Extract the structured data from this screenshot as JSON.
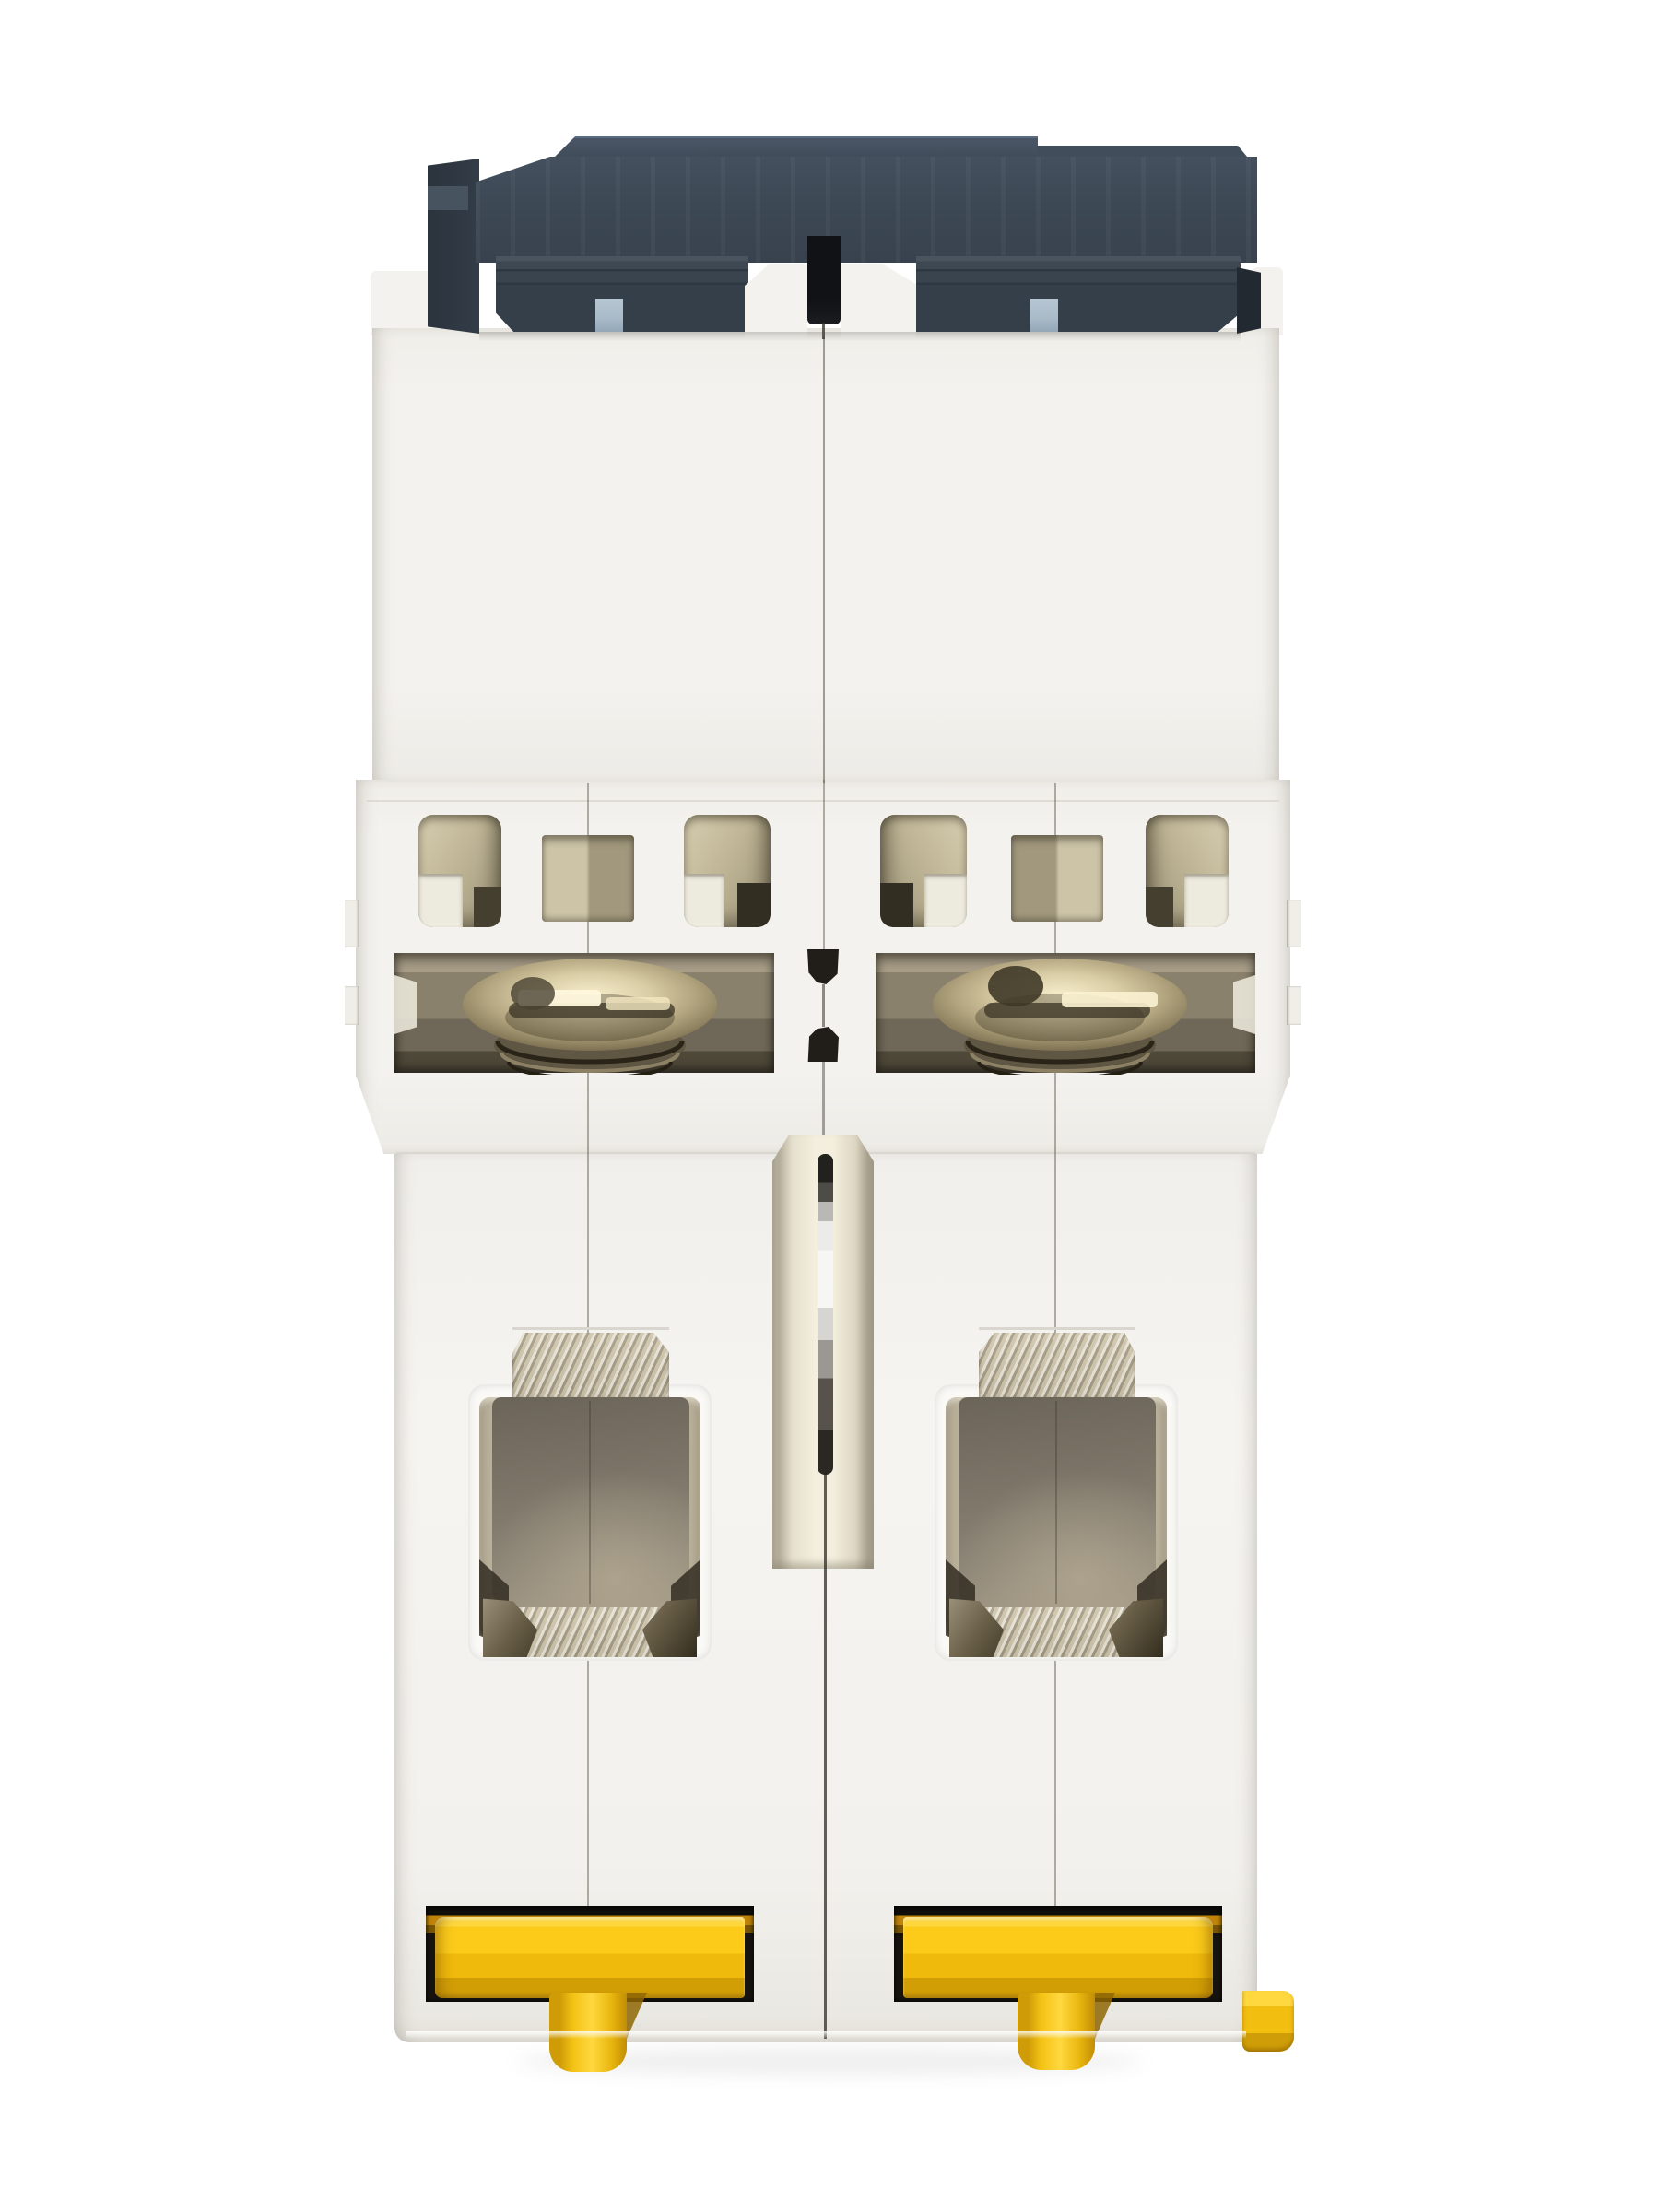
{
  "scene": {
    "subject": "Two-pole miniature circuit breaker, white housing, viewed from the underside on a plain white background",
    "view": "bottom / DIN-rail side",
    "modules": 2
  },
  "parts": {
    "device": {
      "label": "2-pole circuit breaker, underside view"
    },
    "cap": {
      "label": "dark grey top cap"
    },
    "blue_tab": {
      "label": "light blue latch tab"
    },
    "housing_upper": {
      "label": "white housing, upper block"
    },
    "housing_middle": {
      "label": "white housing, middle block with vents"
    },
    "housing_lower": {
      "label": "white housing, lower block"
    },
    "vent_cutout": {
      "label": "vent cutout"
    },
    "screw_recess": {
      "label": "terminal screw recess"
    },
    "terminal_screw": {
      "label": "brass terminal screw head"
    },
    "center_notch": {
      "label": "black centre notch between poles"
    },
    "pin_channel": {
      "label": "centre channel between poles"
    },
    "pole_pin": {
      "label": "metal linking pin"
    },
    "terminal_tab": {
      "label": "metal terminal tab"
    },
    "terminal_cavity": {
      "label": "wire terminal cavity with clamp"
    },
    "clamp_foot": {
      "label": "metal clamp foot"
    },
    "din_clip": {
      "label": "yellow DIN-rail clip"
    },
    "din_clip_stem": {
      "label": "yellow DIN-rail clip stem"
    },
    "din_clip_release": {
      "label": "yellow clip release nub"
    },
    "module_seam": {
      "label": "moulding seam line"
    },
    "ground_shadow": {
      "label": "soft drop shadow"
    }
  },
  "palette": {
    "bg": "#ffffff",
    "body": "#f4f2ee",
    "cap-face": "#3d4855",
    "cap-top": "#4a5666",
    "cap-dark": "#2b333d",
    "blue-tab": "#a9bac8",
    "khaki-light": "#d6cdb0",
    "khaki-mid": "#9a9176",
    "khaki-dark": "#453f30",
    "recess-mid": "#8a816d",
    "bronze-light": "#f7eecb",
    "bronze-mid": "#b3a680",
    "bronze-dark": "#655a41",
    "metal-light": "#cfc6b2",
    "metal-mid": "#b9b09a",
    "cavity-dark": "#6b6458",
    "cavity-light": "#a59b87",
    "yellow-bright": "#fccb1a",
    "yellow-mid": "#f0ba0c",
    "yellow-deep": "#d29e06",
    "amber": "#c08408",
    "recess-black": "#171410",
    "pin-silver": "#f6f6f4",
    "pin-dark": "#2b2823",
    "seam": "rgba(104,99,86,0.5)"
  }
}
